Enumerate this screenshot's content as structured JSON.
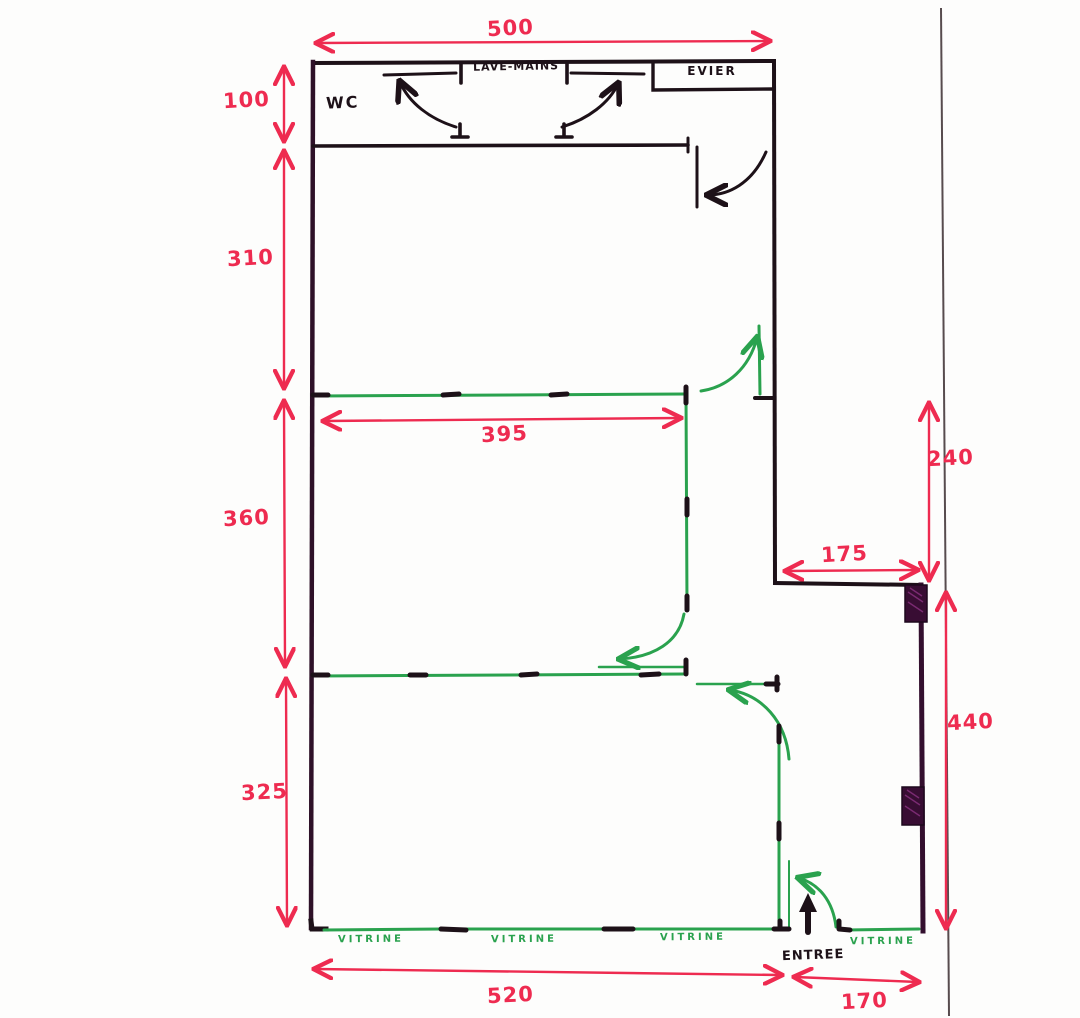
{
  "title": "Hand-drawn shop floor plan sketch",
  "labels": {
    "wc": "WC",
    "lave_mains": "LAVE-MAINS",
    "evier": "EVIER",
    "entree": "ENTREE"
  },
  "vitrines": [
    "VITRINE",
    "VITRINE",
    "VITRINE",
    "VITRINE"
  ],
  "dimensions": {
    "top_width": "500",
    "wc_height": "100",
    "upper_room_height": "310",
    "middle_room_height": "360",
    "lower_room_height": "325",
    "partition_width": "395",
    "recess_height": "240",
    "recess_width": "175",
    "right_side_height": "440",
    "front_width_left": "520",
    "front_width_right": "170"
  },
  "colors": {
    "wall": "#1d1118",
    "wall_purple": "#330f2e",
    "partition": "#2aa24e",
    "dimension": "#ee2b50",
    "pillar": "#380d33",
    "boundary_line": "#574c4e"
  }
}
